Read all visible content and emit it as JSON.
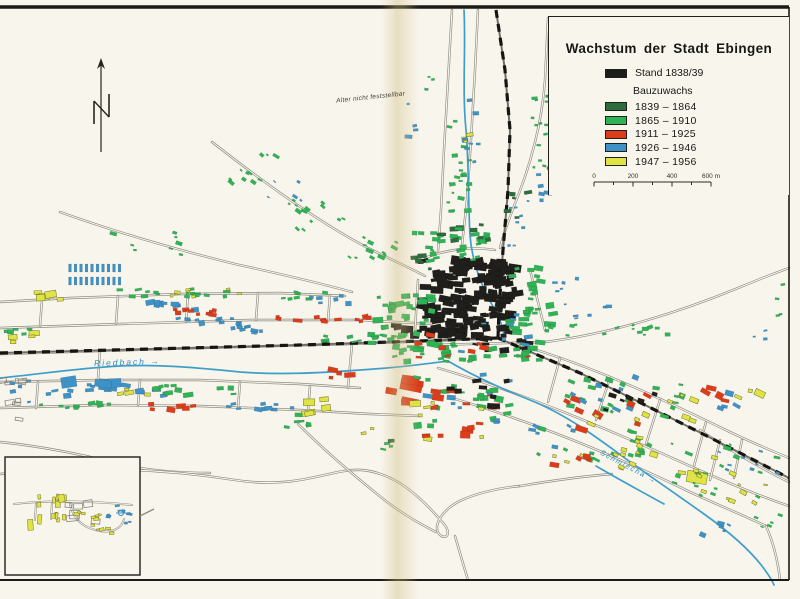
{
  "page": {
    "paper_color": "#f8f5ec",
    "frame_color": "#1b1b18"
  },
  "legend": {
    "title": "Wachstum der Stadt Ebingen",
    "stand_label": "Stand 1838/39",
    "stand_color": "#1c1c1a",
    "bauzuwachs_label": "Bauzuwachs",
    "periods": [
      {
        "label": "1839 – 1864",
        "color": "#2e6b3f"
      },
      {
        "label": "1865 – 1910",
        "color": "#2fb355"
      },
      {
        "label": "1911 – 1925",
        "color": "#dd3c1a"
      },
      {
        "label": "1926 – 1946",
        "color": "#3e92c6"
      },
      {
        "label": "1947 – 1956",
        "color": "#dfe343"
      }
    ],
    "scale_bar": {
      "labels": [
        "0",
        "200",
        "400",
        "600 m"
      ],
      "length_px": 117,
      "meters": 600
    }
  },
  "labels": {
    "north": "N",
    "age_note": "Alter nicht feststellbar",
    "river_west": "Riedbach →",
    "river_south": "Schmiecha →"
  },
  "map": {
    "colors": {
      "road": "#8d8b80",
      "river": "#3f9ec9",
      "rail_base": "#6f6d66",
      "rail_dash": "#151512",
      "fills": {
        "K": "#201f1b",
        "DG": "#2e6b3f",
        "G": "#2fb355",
        "R": "#dd3c1a",
        "B": "#3e92c6",
        "Y": "#dfe343",
        "O": "none"
      }
    },
    "roads": [
      "M0,302 L70,298 L180,294 L280,293 L345,296",
      "M0,328 L120,324 L250,320 L360,320 L432,324",
      "M0,354 L200,348 L350,344 L432,341 L500,338",
      "M0,382 L100,380 L200,380 L300,384 L360,388",
      "M0,408 L100,405 L200,406 L300,410 L370,414 L420,416",
      "M42,300 L40,326",
      "M118,296 L116,324",
      "M188,294 L186,322",
      "M258,293 L256,320",
      "M330,295 L328,321",
      "M38,382 L36,408",
      "M140,380 L138,405",
      "M240,382 L238,408",
      "M310,386 L308,411",
      "M100,350 L98,380",
      "M352,344 L348,388",
      "M60,212 C110,230 170,248 235,264 C290,276 330,286 352,292",
      "M212,142 C258,178 318,222 368,248 C392,260 410,268 425,276",
      "M452,10 L448,80 L444,150 L441,210 L438,252",
      "M478,10 L475,70 L471,140 L467,200 L462,245",
      "M548,18 L545,80 C542,120 532,160 518,196 C510,216 504,232 500,248",
      "M425,258 C445,250 470,246 495,250",
      "M418,280 L415,330",
      "M530,270 L545,330",
      "M432,345 L545,342",
      "M545,342 C610,334 680,312 738,288 C762,278 778,272 789,268",
      "M520,345 C590,365 660,398 730,432 C755,444 775,452 789,458",
      "M438,368 C520,392 610,430 690,466 C730,484 760,496 789,506",
      "M452,398 C540,424 620,458 690,492 C720,506 745,516 766,526",
      "M560,358 L548,402",
      "M610,378 L596,420",
      "M660,400 L646,444",
      "M706,422 L694,466",
      "M742,440 L734,478",
      "M700,430 C730,450 760,468 789,482",
      "M720,440 L710,480",
      "M0,442 C40,446 80,454 120,464 C150,471 180,473 210,473",
      "M0,474 C80,466 160,468 235,480 C300,490 330,468 362,470 C395,473 420,496 444,524 C452,534 446,541 439,534 C432,525 444,508 462,500 C480,492 500,488 520,486",
      "M298,424 C322,448 352,474 382,498 C402,514 420,524 436,532",
      "M455,536 L462,560 L468,580",
      "M520,486 C556,480 586,476 612,474",
      "M766,526 C774,544 778,562 780,580"
    ],
    "rivers": [
      "M0,378 C40,374 80,368 120,366 C160,364 200,368 240,372 C280,375 320,373 360,370 C395,368 425,364 448,361",
      "M464,10 C466,50 462,90 466,130 C469,165 468,200 470,235 C472,262 482,288 495,310 C500,319 503,328 504,336",
      "M448,361 C470,374 500,388 530,400 C565,414 595,436 622,456 C648,475 676,494 704,514 C728,531 748,548 762,566 C768,574 772,580 774,585",
      "M596,466 C620,480 642,492 664,504"
    ],
    "railways": [
      "M496,10 L505,70 L510,130 L508,190 L503,250 L499,310 L498,338",
      "M0,353 L150,349 L300,345 L420,341 L498,338",
      "M498,338 L540,356 L580,373 L625,395 L665,415 L705,435 L748,457 L789,478"
    ],
    "clusters_format": "[colorKey, cx, cy, spreadW, spreadH, count, sizeMin, sizeMax, angleDeg(optional), vertical(optional)]",
    "clusters": [
      [
        "K",
        468,
        299,
        96,
        78,
        150,
        4,
        10
      ],
      [
        "K",
        430,
        330,
        70,
        16,
        18,
        4,
        8
      ],
      [
        "K",
        505,
        345,
        60,
        14,
        12,
        3,
        7
      ],
      [
        "G",
        468,
        352,
        150,
        20,
        40,
        3,
        7
      ],
      [
        "G",
        405,
        315,
        55,
        48,
        32,
        3,
        7
      ],
      [
        "G",
        452,
        247,
        75,
        28,
        26,
        3,
        6
      ],
      [
        "G",
        532,
        300,
        45,
        65,
        30,
        3,
        7
      ],
      [
        "DG",
        462,
        232,
        65,
        18,
        9,
        3,
        6
      ],
      [
        "DG",
        428,
        262,
        30,
        14,
        5,
        3,
        6
      ],
      [
        "R",
        478,
        347,
        130,
        24,
        9,
        3,
        7
      ],
      [
        "B",
        502,
        332,
        90,
        40,
        8,
        3,
        6
      ],
      [
        "G",
        458,
        170,
        26,
        120,
        22,
        2,
        5
      ],
      [
        "B",
        472,
        140,
        22,
        80,
        7,
        2,
        5
      ],
      [
        "G",
        542,
        130,
        22,
        80,
        16,
        2,
        5
      ],
      [
        "B",
        544,
        178,
        18,
        55,
        7,
        2,
        5
      ],
      [
        "DG",
        520,
        210,
        26,
        46,
        5,
        3,
        5
      ],
      [
        "Y",
        470,
        128,
        14,
        30,
        3,
        2,
        5
      ],
      [
        "G",
        258,
        168,
        62,
        30,
        11,
        2,
        5,
        35
      ],
      [
        "G",
        312,
        215,
        70,
        30,
        13,
        2,
        5,
        35
      ],
      [
        "G",
        372,
        250,
        60,
        26,
        12,
        2,
        5,
        25
      ],
      [
        "B",
        285,
        192,
        40,
        24,
        5,
        2,
        4,
        35
      ],
      [
        "G",
        150,
        242,
        90,
        26,
        8,
        2,
        5,
        10
      ],
      [
        "Y",
        45,
        294,
        34,
        14,
        6,
        5,
        9
      ],
      [
        "G",
        170,
        293,
        120,
        8,
        16,
        2,
        5
      ],
      [
        "Y",
        205,
        293,
        90,
        8,
        8,
        2,
        4
      ],
      [
        "B",
        165,
        306,
        70,
        8,
        10,
        3,
        6
      ],
      [
        "R",
        185,
        313,
        60,
        7,
        10,
        3,
        6
      ],
      [
        "B",
        205,
        322,
        90,
        8,
        12,
        3,
        6
      ],
      [
        "B",
        260,
        330,
        60,
        8,
        8,
        3,
        5
      ],
      [
        "G",
        300,
        296,
        60,
        8,
        8,
        3,
        5
      ],
      [
        "R",
        300,
        320,
        50,
        8,
        6,
        3,
        6
      ],
      [
        "B",
        330,
        300,
        40,
        10,
        6,
        3,
        6
      ],
      [
        "G",
        358,
        338,
        75,
        10,
        12,
        3,
        6
      ],
      [
        "R",
        352,
        320,
        40,
        8,
        5,
        3,
        6
      ],
      [
        "Y",
        22,
        338,
        30,
        10,
        4,
        4,
        8
      ],
      [
        "G",
        20,
        330,
        30,
        8,
        5,
        3,
        5
      ],
      [
        "B",
        105,
        390,
        120,
        12,
        14,
        3,
        7
      ],
      [
        "B",
        90,
        385,
        50,
        10,
        4,
        8,
        13
      ],
      [
        "G",
        200,
        390,
        90,
        10,
        12,
        3,
        6
      ],
      [
        "R",
        165,
        406,
        60,
        8,
        6,
        3,
        6
      ],
      [
        "B",
        255,
        406,
        80,
        8,
        10,
        3,
        6
      ],
      [
        "G",
        75,
        406,
        70,
        8,
        9,
        3,
        5
      ],
      [
        "Y",
        135,
        392,
        30,
        8,
        4,
        3,
        6
      ],
      [
        "O",
        12,
        400,
        22,
        40,
        8,
        4,
        8
      ],
      [
        "B",
        20,
        393,
        18,
        25,
        5,
        2,
        4
      ],
      [
        "R",
        400,
        390,
        36,
        30,
        6,
        7,
        14
      ],
      [
        "G",
        462,
        402,
        95,
        55,
        24,
        3,
        7
      ],
      [
        "R",
        465,
        412,
        90,
        50,
        11,
        4,
        8
      ],
      [
        "B",
        468,
        398,
        90,
        50,
        9,
        3,
        7
      ],
      [
        "Y",
        450,
        420,
        70,
        40,
        7,
        3,
        7
      ],
      [
        "K",
        470,
        392,
        80,
        30,
        8,
        3,
        6
      ],
      [
        "Y",
        325,
        408,
        34,
        20,
        5,
        5,
        10
      ],
      [
        "G",
        302,
        420,
        45,
        16,
        6,
        3,
        5
      ],
      [
        "R",
        345,
        372,
        30,
        14,
        4,
        4,
        8
      ],
      [
        "G",
        625,
        398,
        120,
        40,
        20,
        3,
        6,
        20
      ],
      [
        "R",
        605,
        412,
        90,
        36,
        8,
        4,
        8,
        20
      ],
      [
        "B",
        615,
        392,
        100,
        36,
        8,
        3,
        6,
        20
      ],
      [
        "Y",
        640,
        408,
        110,
        36,
        9,
        3,
        6,
        20
      ],
      [
        "K",
        628,
        400,
        90,
        20,
        6,
        3,
        6,
        20
      ],
      [
        "G",
        600,
        445,
        130,
        40,
        16,
        3,
        6,
        20
      ],
      [
        "Y",
        605,
        452,
        120,
        36,
        14,
        3,
        6,
        20
      ],
      [
        "B",
        560,
        440,
        60,
        30,
        6,
        3,
        6,
        20
      ],
      [
        "R",
        565,
        455,
        50,
        24,
        4,
        3,
        7,
        20
      ],
      [
        "Y",
        697,
        477,
        10,
        6,
        1,
        14,
        16,
        20
      ],
      [
        "R",
        718,
        396,
        40,
        18,
        4,
        4,
        8,
        20
      ],
      [
        "B",
        724,
        402,
        40,
        18,
        4,
        3,
        6,
        20
      ],
      [
        "Y",
        748,
        392,
        24,
        12,
        3,
        4,
        7,
        20
      ],
      [
        "G",
        725,
        470,
        110,
        60,
        18,
        2,
        5,
        20
      ],
      [
        "Y",
        730,
        478,
        100,
        50,
        12,
        2,
        5,
        20
      ],
      [
        "B",
        748,
        462,
        60,
        24,
        8,
        2,
        4,
        20
      ],
      [
        "B",
        722,
        528,
        40,
        24,
        5,
        2,
        5,
        20
      ],
      [
        "G",
        770,
        518,
        30,
        20,
        5,
        2,
        4,
        20
      ],
      [
        "G",
        630,
        328,
        90,
        14,
        10,
        2,
        5,
        -10
      ],
      [
        "B",
        592,
        312,
        40,
        14,
        5,
        2,
        4,
        -10
      ],
      [
        "B",
        516,
        226,
        26,
        50,
        8,
        2,
        4
      ],
      [
        "B",
        565,
        290,
        24,
        30,
        6,
        2,
        4
      ],
      [
        "G",
        560,
        330,
        40,
        12,
        5,
        2,
        4
      ],
      [
        "G",
        778,
        300,
        16,
        40,
        4,
        2,
        4
      ],
      [
        "B",
        760,
        330,
        16,
        30,
        3,
        2,
        4
      ],
      [
        "B",
        415,
        120,
        14,
        40,
        4,
        2,
        5
      ],
      [
        "G",
        432,
        90,
        14,
        30,
        3,
        2,
        4
      ],
      [
        "G",
        398,
        448,
        30,
        20,
        3,
        2,
        4
      ],
      [
        "R",
        432,
        430,
        20,
        14,
        3,
        3,
        5
      ],
      [
        "DG",
        395,
        442,
        8,
        6,
        1,
        3,
        4
      ],
      [
        "Y",
        368,
        430,
        10,
        8,
        2,
        2,
        4
      ]
    ],
    "row_clusters": [
      {
        "c": "B",
        "x": 70,
        "y": 268,
        "cols": 10,
        "rows": 2,
        "dx": 5.5,
        "dy": 13,
        "bw": 2.8,
        "bh": 8
      }
    ],
    "inset": {
      "box": [
        5,
        457,
        135,
        118
      ],
      "roads": [
        "M14,504 C45,500 95,501 132,505",
        "M70,504 C73,518 82,528 100,531 C113,533 122,528 124,519",
        "M36,504 L35,520",
        "M52,503 L51,519"
      ],
      "clusters": [
        [
          "Y",
          45,
          511,
          42,
          30,
          14,
          3,
          7,
          0,
          1
        ],
        [
          "O",
          85,
          516,
          34,
          26,
          6,
          6,
          10
        ],
        [
          "Y",
          86,
          514,
          32,
          24,
          8,
          2,
          4
        ],
        [
          "B",
          120,
          513,
          26,
          22,
          10,
          2,
          4
        ],
        [
          "Y",
          106,
          530,
          22,
          8,
          4,
          2,
          4
        ]
      ],
      "symbol": {
        "x": 121,
        "y": 513
      },
      "leader": "M140,516 L154,509"
    },
    "north_arrow": {
      "x": 101,
      "top": 58,
      "bottom": 152
    }
  }
}
